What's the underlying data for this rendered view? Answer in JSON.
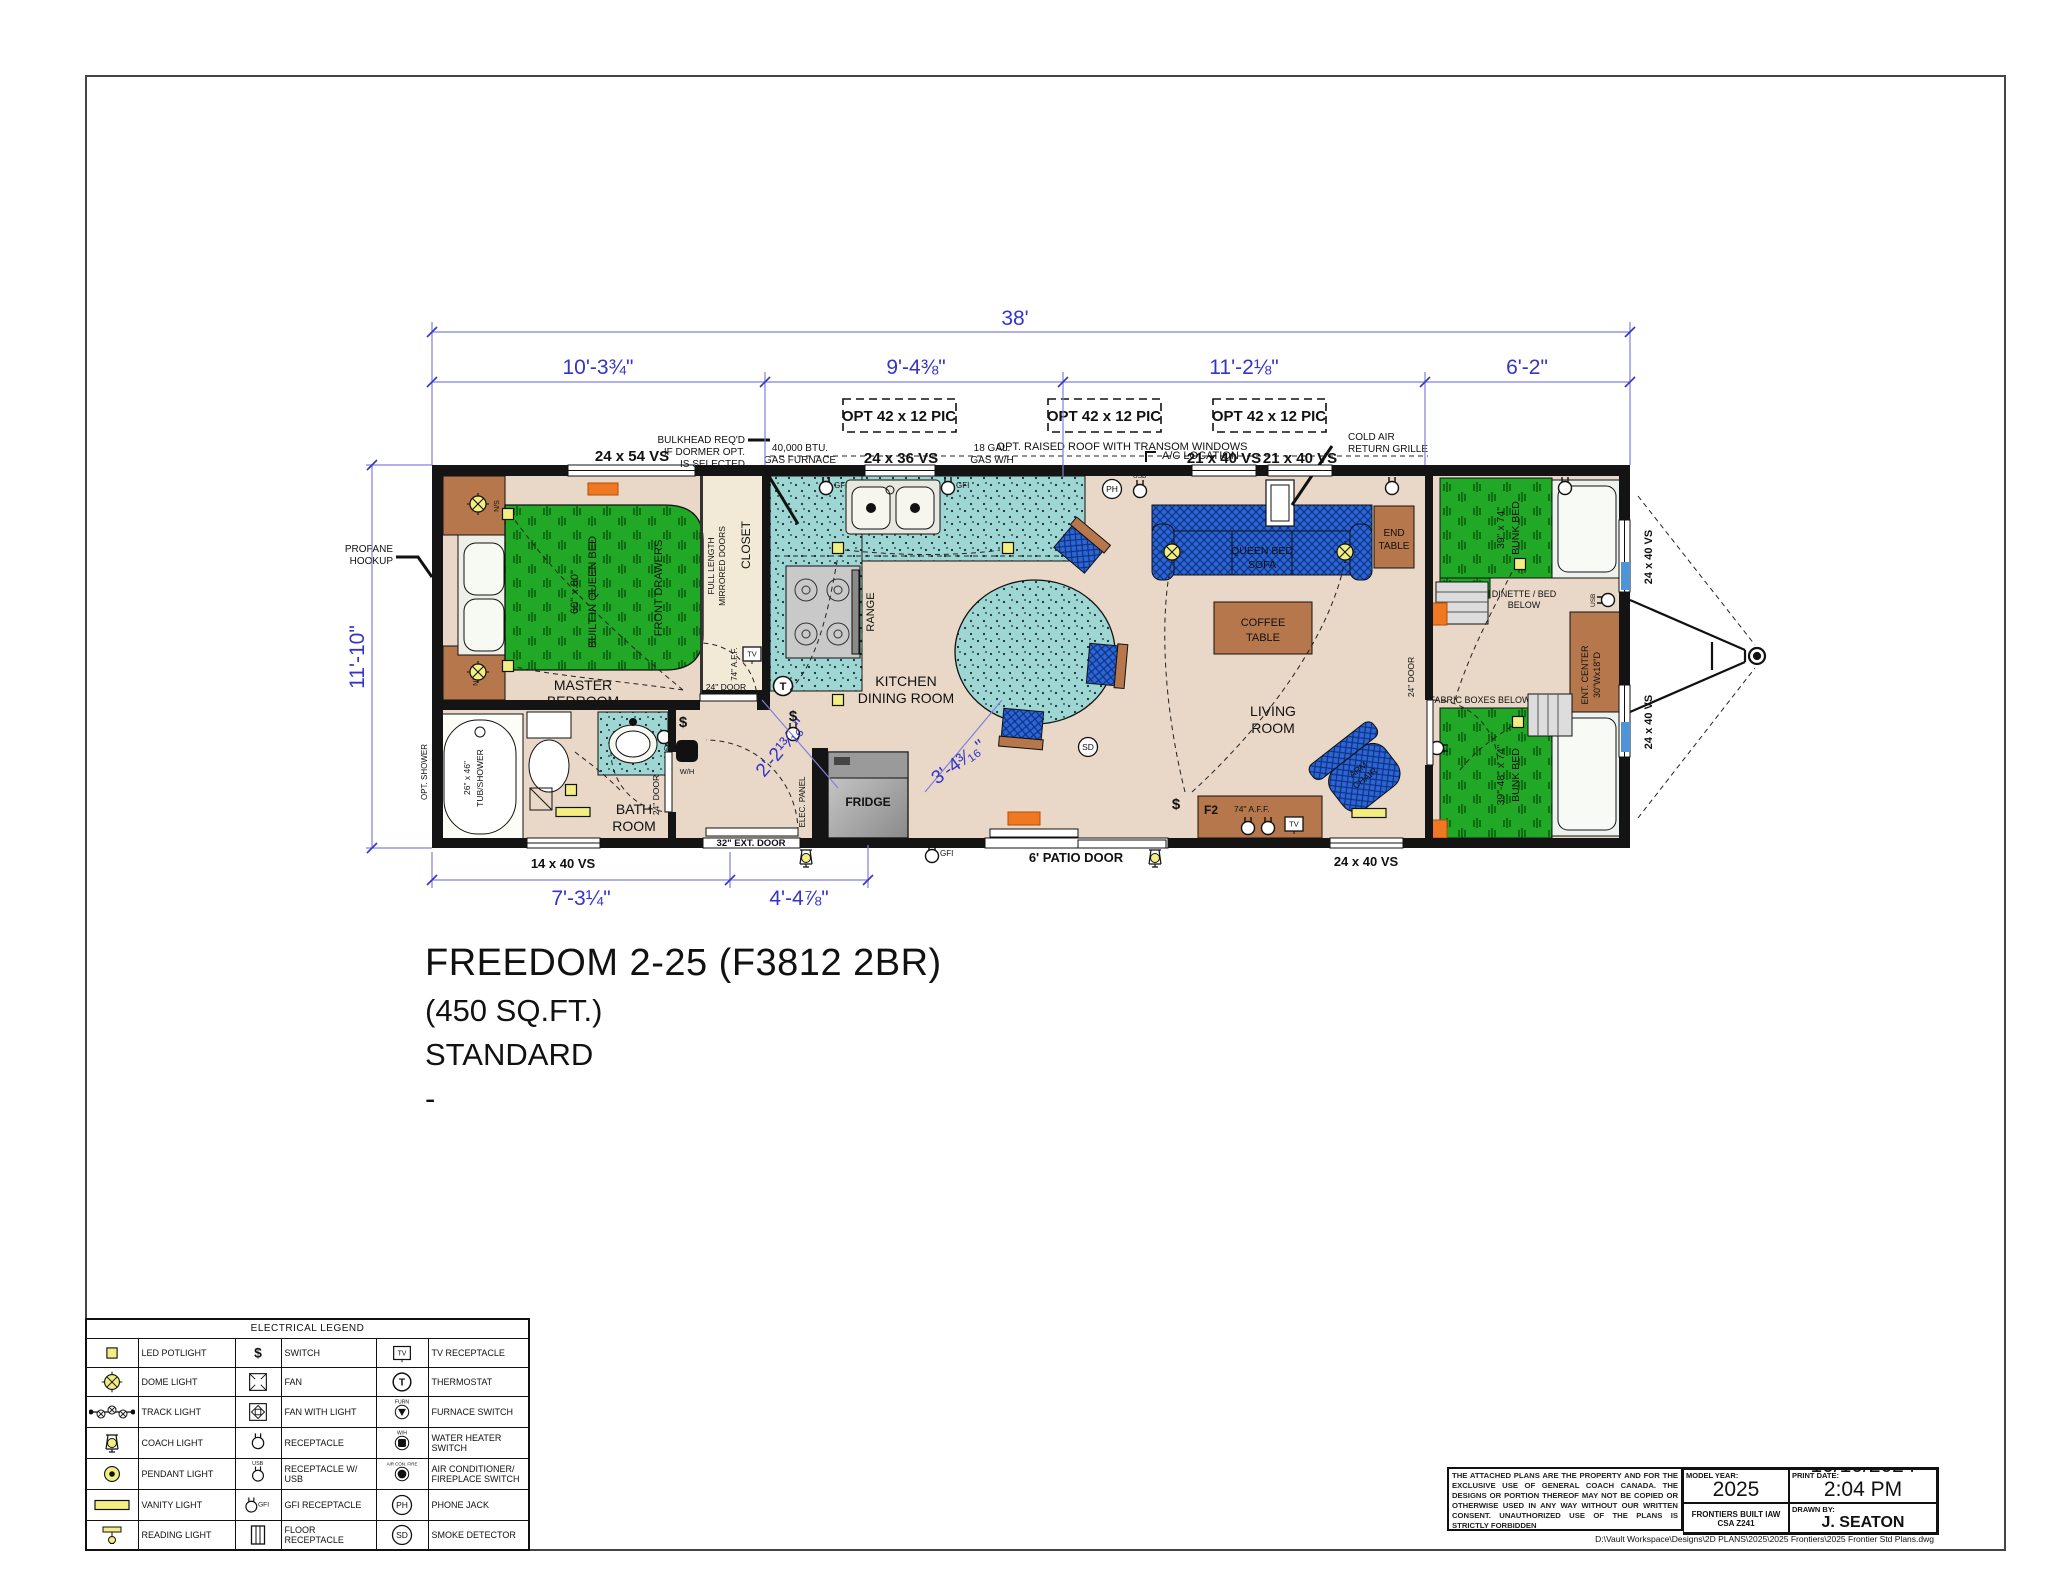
{
  "sheet": {
    "title_line1": "FREEDOM 2-25 (F3812 2BR)",
    "title_line2": "(450 SQ.FT.)",
    "title_line3": "STANDARD",
    "title_line4": "-"
  },
  "dims": {
    "overall": "38'",
    "seg1": "10'-3¾\"",
    "seg2": "9'-4⅜\"",
    "seg3": "11'-2⅛\"",
    "seg4": "6'-2\"",
    "left": "11'-10\"",
    "bottom1": "7'-3¼\"",
    "bottom2": "4'-4⅞\"",
    "diag1": "2'-2¹³⁄₁₆\"",
    "diag2": "3'-4³⁄₁₆\""
  },
  "windows": {
    "w_24x54": "24 x 54 VS",
    "w_24x36": "24 x 36 VS",
    "w_21x40_a": "21 x 40 VS",
    "w_21x40_b": "21 x 40 VS",
    "w_14x40": "14 x 40 VS",
    "w_24x40_bottom": "24 x 40 VS",
    "w_24x40_right_top": "24 x 40 VS",
    "w_24x40_right_bottom": "24 x 40 VS",
    "opt_pic_1": "OPT 42 x 12 PIC",
    "opt_pic_2": "OPT 42 x 12 PIC",
    "opt_pic_3": "OPT 42 x 12 PIC"
  },
  "notes": {
    "bulkhead_1": "BULKHEAD REQ'D",
    "bulkhead_2": "IF DORMER OPT.",
    "bulkhead_3": "IS SELECTED",
    "furnace_1": "40,000 BTU.",
    "furnace_2": "GAS FURNACE",
    "gas_wh_1": "18 GAL.",
    "gas_wh_2": "GAS W/H",
    "raised_roof": "OPT. RAISED ROOF WITH TRANSOM WINDOWS",
    "ac_location": "A/C LOCATION",
    "cold_air_1": "COLD AIR",
    "cold_air_2": "RETURN GRILLE",
    "propane_1": "PROPANE",
    "propane_2": "HOOKUP"
  },
  "rooms": {
    "master_1": "MASTER",
    "master_2": "BEDROOM",
    "bath_1": "BATH",
    "bath_2": "ROOM",
    "kitchen_1": "KITCHEN",
    "kitchen_2": "DINING ROOM",
    "living_1": "LIVING",
    "living_2": "ROOM"
  },
  "furniture": {
    "queen_size": "60\" x 80\"",
    "queen_name": "BUILT IN QUEEN BED",
    "front_drawers": "FRONT DRAWERS",
    "closet_doors_1": "FULL LENGTH",
    "closet_doors_2": "MIRRORED DOORS",
    "closet": "CLOSET",
    "range": "RANGE",
    "fridge": "FRIDGE",
    "tub_size": "26\" x 46\"",
    "tub_name": "TUB/SHOWER",
    "opt_shower": "OPT. SHOWER",
    "sofa_1": "QUEEN BED",
    "sofa_2": "SOFA",
    "coffee_1": "COFFEE",
    "coffee_2": "TABLE",
    "end_1": "END",
    "end_2": "TABLE",
    "arm_1": "ARM",
    "arm_2": "CHAIR",
    "ent_1": "ENT. CENTER",
    "ent_2": "30\"Wx18\"D",
    "bunk_top_size": "39\" x 74\"",
    "bunk_top_name": "BUNK BED",
    "bunk_bot_size": "39\"-48\" x 74\"",
    "bunk_bot_name": "BUNK BED",
    "dinette_1": "DINETTE / BED",
    "dinette_2": "BELOW",
    "fabric_boxes": "FABRIC BOXES BELOW"
  },
  "doors": {
    "bedroom": "24\" DOOR",
    "bath": "24\" DOOR",
    "bunk": "24\" DOOR",
    "ext": "32\" EXT. DOOR",
    "patio": "6' PATIO DOOR"
  },
  "symbols": {
    "elec_panel": "ELEC. PANEL",
    "aff": "74\" A.F.F.",
    "aff_closet": "74\" A.F.F."
  },
  "glyphs": {
    "dollar": "$",
    "sd": "SD",
    "ph": "PH",
    "t": "T",
    "tv": "TV",
    "gfi": "GFI",
    "usb": "USB",
    "wh": "W/H",
    "furn": "FURN",
    "acfire": "AIR CON. FIRE",
    "f2": "F2",
    "ns": "N/S"
  },
  "legend": {
    "header": "ELECTRICAL LEGEND",
    "rows": [
      {
        "l1": "LED POTLIGHT",
        "l2": "SWITCH",
        "l3": "TV RECEPTACLE"
      },
      {
        "l1": "DOME LIGHT",
        "l2": "FAN",
        "l3": "THERMOSTAT"
      },
      {
        "l1": "TRACK LIGHT",
        "l2": "FAN WITH LIGHT",
        "l3": "FURNACE SWITCH"
      },
      {
        "l1": "COACH LIGHT",
        "l2": "RECEPTACLE",
        "l3": "WATER HEATER SWITCH"
      },
      {
        "l1": "PENDANT LIGHT",
        "l2": "RECEPTACLE W/ USB",
        "l3": "AIR CONDITIONER/ FIREPLACE SWITCH"
      },
      {
        "l1": "VANITY LIGHT",
        "l2": "GFI RECEPTACLE",
        "l3": "PHONE JACK"
      },
      {
        "l1": "READING LIGHT",
        "l2": "FLOOR RECEPTACLE",
        "l3": "SMOKE DETECTOR"
      }
    ]
  },
  "infoblock": {
    "disclaimer": "THE ATTACHED PLANS ARE THE PROPERTY AND FOR THE EXCLUSIVE USE OF GENERAL COACH CANADA. THE DESIGNS OR PORTION THEREOF MAY NOT BE COPIED OR OTHERWISE USED IN ANY WAY WITHOUT OUR WRITTEN CONSENT. UNAUTHORIZED USE OF THE PLANS IS STRICTLY FORBIDDEN",
    "model_year_label": "MODEL YEAR:",
    "model_year": "2025",
    "print_date_label": "PRINT DATE:",
    "print_date": "10/10/2024 2:04 PM",
    "frontiers": "FRONTIERS BUILT IAW CSA Z241",
    "drawn_by_label": "DRAWN BY:",
    "drawn_by": "J. SEATON",
    "file_path": "D:\\Vault Workspace\\Designs\\2D PLANS\\2025\\2025 Frontiers\\2025 Frontier Std Plans.dwg"
  }
}
